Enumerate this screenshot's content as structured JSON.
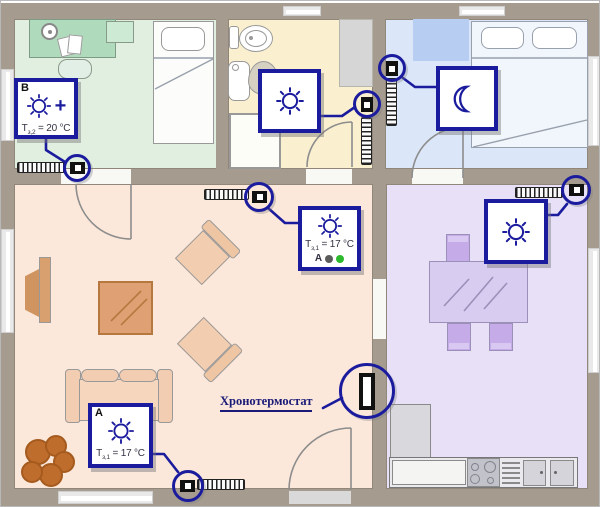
{
  "annotation": {
    "chronothermostat": "Хронотермостат"
  },
  "icons": {
    "sun": "sun-icon (comfort heating mode)",
    "moon": "moon-icon (night setback mode)",
    "plus": "+",
    "valve": "radiator-valve-actuator",
    "radiator": "radiator-coil",
    "chronothermostat_device": "wall-mounted-chronothermostat"
  },
  "boxes": {
    "b": {
      "corner": "B",
      "temp_t": "T",
      "temp_sub": "з,2",
      "temp_val": "= 20 °C"
    },
    "living_top": {
      "temp_t": "T",
      "temp_sub": "з,1",
      "temp_val": "= 17 °C",
      "zone": "A"
    },
    "a": {
      "corner": "A",
      "temp_t": "T",
      "temp_sub": "з,1",
      "temp_val": "= 17 °C"
    }
  },
  "colors": {
    "accent_navy": "#1b1b9e",
    "wall": "#a59c8f",
    "room_green": "#e1efe0",
    "room_cream": "#faf0d0",
    "room_blue": "#dbe7f8",
    "room_peach": "#fce8da",
    "room_purple": "#e7e0f7",
    "status_dot_gray": "#5c5c5c",
    "status_dot_green": "#2db92d"
  }
}
